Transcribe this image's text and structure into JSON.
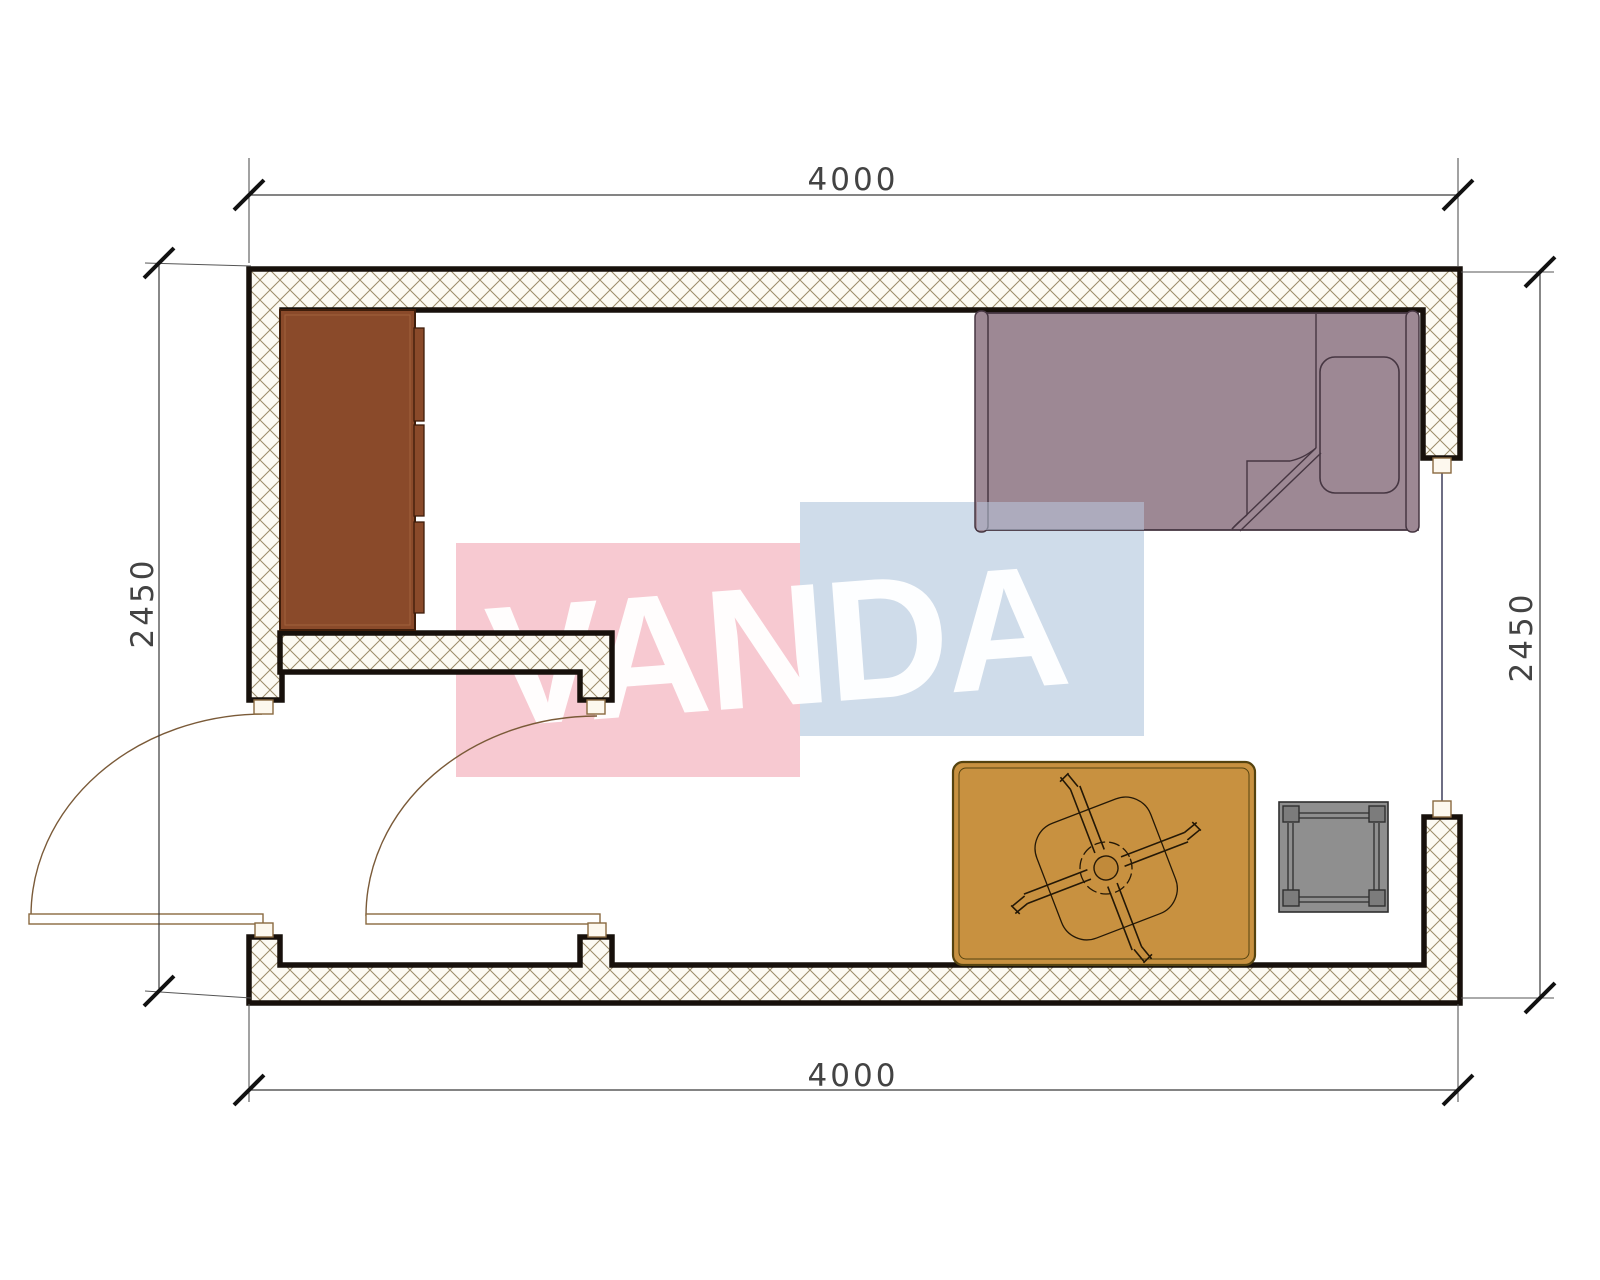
{
  "title": "Room floor plan drawing",
  "watermark": {
    "text": "VANDA",
    "pink": "#f7c9d1",
    "blue": "#cfdcea",
    "overlay_blue": "#b9c8de",
    "text_color": "#ffffff"
  },
  "dimensions": {
    "top": {
      "value": "4000"
    },
    "bottom": {
      "value": "4000"
    },
    "left": {
      "value": "2450"
    },
    "right": {
      "value": "2450"
    }
  },
  "colors": {
    "wall_line": "#17100b",
    "wall_fill": "#fcfaf3",
    "hatch_line": "#9b8b68",
    "dim_line": "#3a3a3a",
    "wardrobe": "#8a4a2a",
    "wardrobe_border": "#3f1d0a",
    "bed": "#9d8894",
    "bed_border": "#463642",
    "rug": "#c89140",
    "rug_border": "#55430f",
    "fan_line": "#241806",
    "stool": "#8f8f8f",
    "stool_border": "#2f2f2f",
    "door_line": "#8a6a40",
    "jamb_fill": "#fdf8ee"
  },
  "furniture": [
    {
      "name": "wardrobe"
    },
    {
      "name": "single-bed"
    },
    {
      "name": "pillow"
    },
    {
      "name": "rug"
    },
    {
      "name": "ceiling-fan"
    },
    {
      "name": "stool"
    }
  ]
}
